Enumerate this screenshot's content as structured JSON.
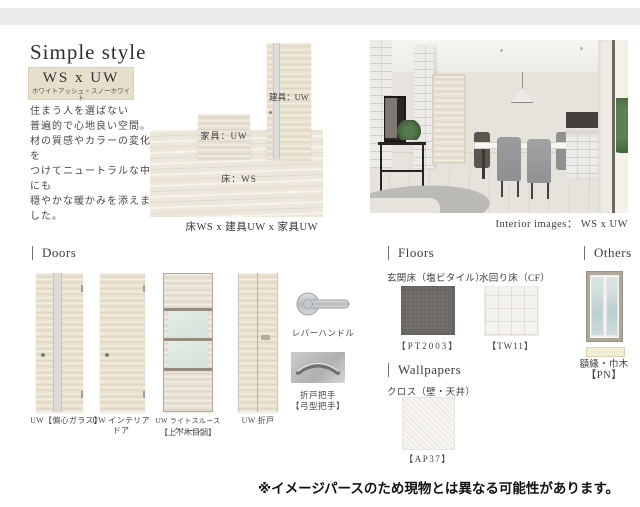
{
  "header": {
    "title": "Simple style",
    "style_code": "WS x UW",
    "style_code_sub": "ホワイトアッシュ × スノーホワイト",
    "description_lines": [
      "住まう人を選ばない",
      "普遍的で心地良い空間。",
      "材の質感やカラーの変化を",
      "つけてニュートラルな中にも",
      "穏やかな暖かみを添えました。"
    ]
  },
  "material_diagram": {
    "floor_label": "床：WS",
    "furniture_label": "家具：UW",
    "door_label": "建具：UW",
    "caption": "床WS x 建具UW x 家具UW"
  },
  "interior": {
    "caption": "Interior images： WS x UW"
  },
  "doors": {
    "header": "Doors",
    "items": [
      {
        "label": "UW【偏心ガラス】"
      },
      {
        "label": "UW インテリアドア"
      },
      {
        "label": "UW ライトスルースクリーン",
        "label2": "【上下木目調】"
      },
      {
        "label": "UW 折戸"
      }
    ],
    "lever_handle_label": "レバーハンドル",
    "bifold_handle_label": "折戸把手",
    "bifold_handle_label2": "【弓型把手】"
  },
  "floors": {
    "header": "Floors",
    "items": [
      {
        "name": "玄関床（塩ビタイル）",
        "code": "【PT2003】",
        "color": "#6e6b67"
      },
      {
        "name": "水回り床（CF）",
        "code": "【TW11】",
        "color": "#f4f2ec"
      }
    ]
  },
  "wallpapers": {
    "header": "Wallpapers",
    "name": "クロス（壁・天井）",
    "code": "【AP37】",
    "color": "#efece6"
  },
  "others": {
    "header": "Others",
    "name": "額縁・巾木",
    "code": "【PN】"
  },
  "note": "※イメージパースのため現物とは異なる可能性があります。",
  "colors": {
    "top_bar": "#ebebeb",
    "style_box": "#e7dfcc",
    "wood_light": "#e9e1d2",
    "floor_ws": "#ece7db",
    "glass": "#dce9e2"
  }
}
